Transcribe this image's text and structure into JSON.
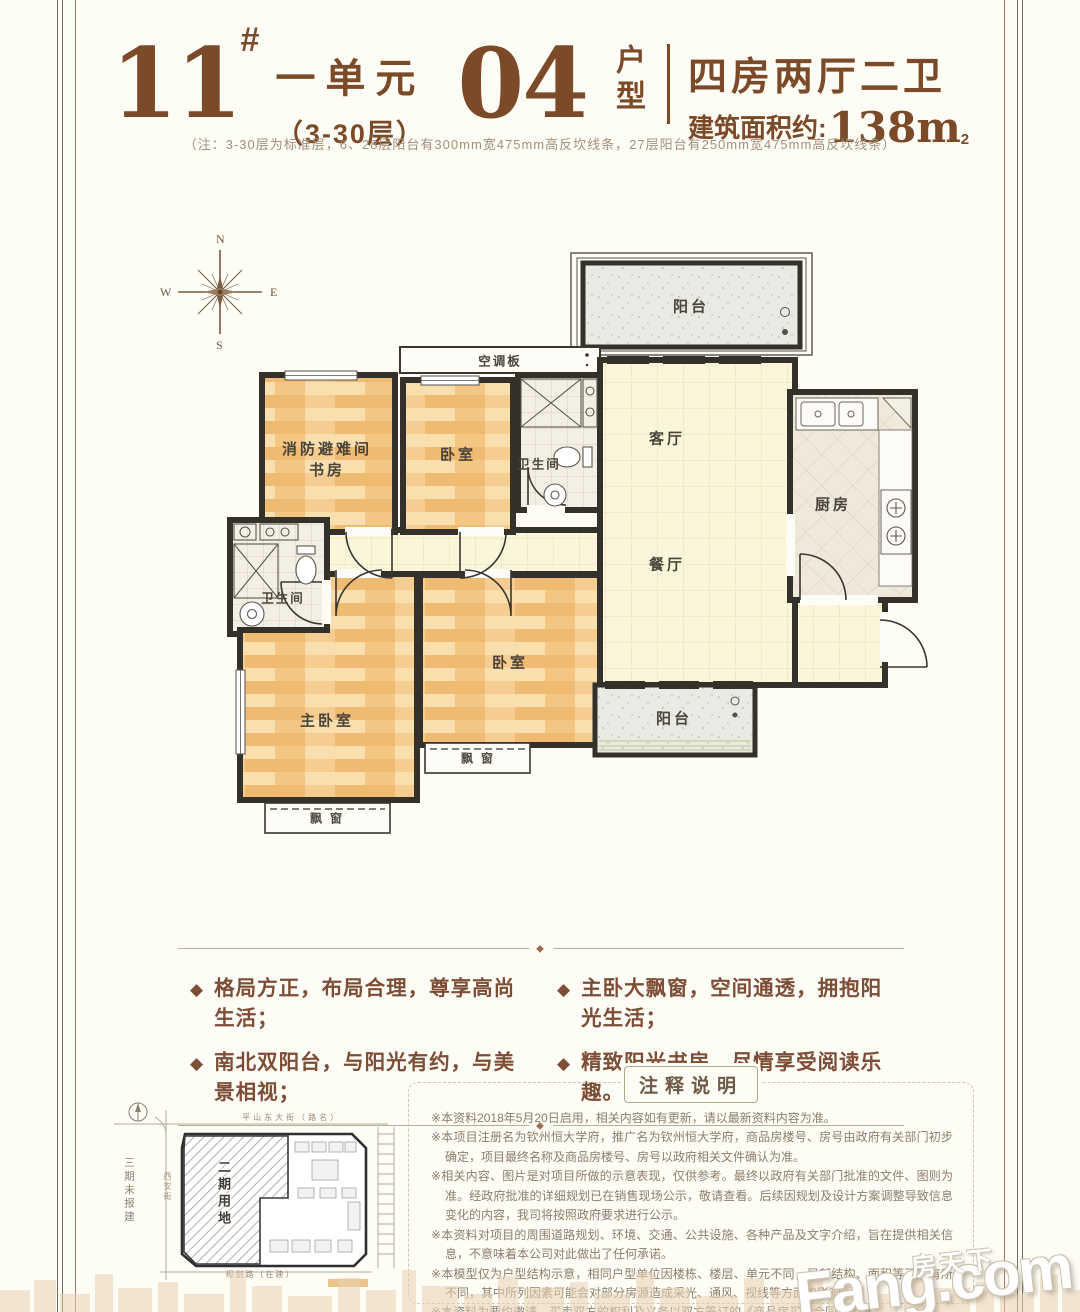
{
  "colors": {
    "accent_brown": "#7b4a28",
    "wall_dark": "#34302a",
    "wood_floor": "#f4c985",
    "hall_floor": "#fbf6da",
    "balcony_gray": "#eaeae5",
    "divider_line": "#bfab97",
    "background": "#fdfcf5"
  },
  "header": {
    "building_no": "11",
    "hash": "#",
    "unit": "一单元",
    "floors": "（3-30层）",
    "unit_no": "04",
    "unit_type_label": "户型",
    "layout": "四房两厅二卫",
    "area_label": "建筑面积约:",
    "area_value": "138m",
    "area_sup": "2"
  },
  "subnote": "（注：3-30层为标准层，6、28层阳台有300mm宽475mm高反坎线条，27层阳台有250mm宽475mm高反坎线条）",
  "compass": {
    "n": "N",
    "s": "S",
    "e": "E",
    "w": "W"
  },
  "floorplan": {
    "labels": {
      "balcony_top": "阳台",
      "ac_board": "空调板",
      "refuge_line1": "消防避难间",
      "refuge_line2": "书房",
      "bedroom_top": "卧室",
      "bath_top": "卫生间",
      "living": "客厅",
      "dining": "餐厅",
      "kitchen": "厨房",
      "bath_left": "卫生间",
      "master": "主卧室",
      "bedroom_bottom": "卧室",
      "bay_master": "飘窗",
      "bay_bedroom": "飘窗",
      "balcony_bottom": "阳台"
    }
  },
  "features": {
    "bullet": "◆",
    "ornament": "◆",
    "items": [
      "格局方正，布局合理，尊享高尚生活；",
      "主卧大飘窗，空间通透，拥抱阳光生活；",
      "南北双阳台，与阳光有约，与美景相视；",
      "精致阳光书房，尽情享受阅读乐趣。"
    ]
  },
  "siteplan": {
    "phase2": "二期用地",
    "phase3": "三期未报建",
    "road_top": "平山东大街（路名）",
    "road_bottom": "规划路（在建）",
    "road_left": "西安街"
  },
  "notes": {
    "title": "注释说明",
    "marker": "※",
    "items": [
      "本资料2018年5月20日启用，相关内容如有更新，请以最新资料内容为准。",
      "本项目注册名为钦州恒大学府，推广名为钦州恒大学府，商品房楼号、房号由政府有关部门初步确定，项目最终名称及商品房楼号、房号以政府相关文件确认为准。",
      "相关内容、图片是对项目所做的示意表现，仅供参考。最终以政府有关部门批准的文件、图则为准。经政府批准的详细规划已在销售现场公示，敬请查看。后续因规划及设计方案调整导致信息变化的内容，我司将按照政府要求进行公示。",
      "本资料对项目的周围道路规划、环境、交通、公共设施、各种产品及文字介绍，旨在提供相关信息，不意味着本公司对此做出了任何承诺。",
      "本模型仅为户型结构示意，相同户型单位因楼栋、楼层、单元不同，局部结构、面积等可能有所不同，其中所列因素可能会对部分房源造成采光、通风、视线等方面的影响。",
      "本资料为要约邀请，买卖双方的权利及义务以双方签订的《商品房买卖合同》为准。"
    ]
  },
  "watermark": {
    "cn": "房天下",
    "en": "Fang.com"
  }
}
